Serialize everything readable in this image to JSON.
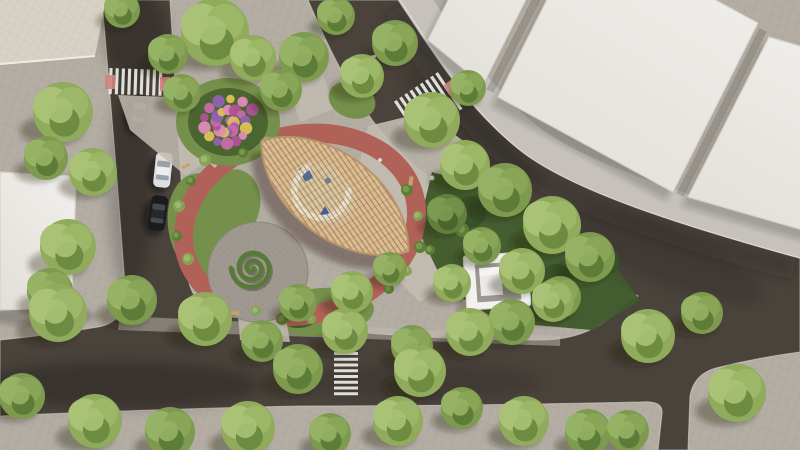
{
  "scene": {
    "view": {
      "width": 800,
      "height": 450
    }
  },
  "colors": {
    "sidewalk": "#b3ada4",
    "sidewalk_band": "#c6c2bb",
    "road": "#4a433c",
    "road_edge": "#cfc9c0",
    "building_white": "#e9e7e2",
    "building_edge": "#d3d0ca",
    "building_beige": "#d8d1c5",
    "lawn_mid": "#75904a",
    "lawn_dark": "#4a6530",
    "lawn_deep": "#3f5a2b",
    "path_light": "#c2bbb0",
    "ring_path": "#b06158",
    "cobble": "#9e978e",
    "hedge": "#577a36",
    "pergola_wood": "#dcbd92",
    "pergola_edge": "#b6956c",
    "pergola_floor": "#d9c6a2",
    "pergola_arc": "#ece2cf",
    "kiosk_white": "#f2f1ef",
    "kiosk_inner": "#999791",
    "crosswalk_stripe": "#edebe7",
    "ramp_pink": "#d4827c",
    "shadow": "rgba(25,22,16,0.32)"
  },
  "tree_palettes": [
    [
      "#8fab5b",
      "#a9c276",
      "#6d8c41",
      "#9cb768"
    ],
    [
      "#7d9a4e",
      "#96b264",
      "#5d7c38",
      "#88a558"
    ],
    [
      "#637f3d",
      "#7d9a52",
      "#4c652f",
      "#719048"
    ]
  ],
  "trees": [
    [
      122,
      10,
      18,
      1
    ],
    [
      215,
      32,
      34,
      0
    ],
    [
      168,
      54,
      20,
      1
    ],
    [
      253,
      58,
      23,
      0
    ],
    [
      304,
      57,
      25,
      1
    ],
    [
      336,
      16,
      19,
      1
    ],
    [
      362,
      76,
      22,
      0
    ],
    [
      395,
      43,
      23,
      1
    ],
    [
      63,
      112,
      30,
      0
    ],
    [
      46,
      158,
      22,
      1
    ],
    [
      93,
      172,
      24,
      0
    ],
    [
      68,
      247,
      28,
      0
    ],
    [
      50,
      291,
      23,
      1
    ],
    [
      182,
      93,
      19,
      1
    ],
    [
      281,
      90,
      21,
      1
    ],
    [
      432,
      120,
      28,
      0
    ],
    [
      468,
      88,
      18,
      1
    ],
    [
      465,
      165,
      25,
      0
    ],
    [
      505,
      190,
      27,
      1
    ],
    [
      552,
      225,
      29,
      0
    ],
    [
      590,
      257,
      25,
      1
    ],
    [
      447,
      214,
      20,
      2
    ],
    [
      482,
      246,
      19,
      1
    ],
    [
      522,
      271,
      23,
      0
    ],
    [
      560,
      297,
      21,
      1
    ],
    [
      452,
      283,
      19,
      0
    ],
    [
      512,
      322,
      23,
      1
    ],
    [
      553,
      301,
      21,
      0
    ],
    [
      298,
      303,
      19,
      1
    ],
    [
      352,
      292,
      21,
      0
    ],
    [
      390,
      269,
      17,
      1
    ],
    [
      58,
      313,
      29,
      0
    ],
    [
      132,
      300,
      25,
      1
    ],
    [
      205,
      319,
      27,
      0
    ],
    [
      262,
      341,
      21,
      1
    ],
    [
      345,
      331,
      23,
      0
    ],
    [
      412,
      346,
      21,
      1
    ],
    [
      470,
      332,
      24,
      0
    ],
    [
      298,
      369,
      25,
      1
    ],
    [
      420,
      371,
      26,
      0
    ],
    [
      22,
      396,
      23,
      1
    ],
    [
      95,
      421,
      27,
      0
    ],
    [
      170,
      432,
      25,
      1
    ],
    [
      248,
      428,
      27,
      0
    ],
    [
      330,
      434,
      21,
      1
    ],
    [
      398,
      421,
      25,
      0
    ],
    [
      462,
      408,
      21,
      1
    ],
    [
      524,
      421,
      25,
      0
    ],
    [
      588,
      432,
      23,
      1
    ],
    [
      648,
      336,
      27,
      0
    ],
    [
      702,
      313,
      21,
      1
    ],
    [
      737,
      393,
      29,
      0
    ],
    [
      628,
      431,
      21,
      1
    ]
  ],
  "shrubs": [
    [
      205,
      160,
      6
    ],
    [
      191,
      181,
      5
    ],
    [
      179,
      206,
      6
    ],
    [
      177,
      236,
      5
    ],
    [
      188,
      259,
      6
    ],
    [
      243,
      153,
      5
    ],
    [
      267,
      141,
      5
    ],
    [
      407,
      190,
      6
    ],
    [
      418,
      216,
      5
    ],
    [
      420,
      247,
      6
    ],
    [
      407,
      271,
      5
    ],
    [
      389,
      289,
      5
    ],
    [
      311,
      319,
      5
    ],
    [
      282,
      319,
      6
    ],
    [
      256,
      311,
      5
    ],
    [
      462,
      230,
      7
    ],
    [
      478,
      262,
      6
    ],
    [
      430,
      250,
      5
    ]
  ],
  "stones": [
    [
      352,
      291,
      2.5
    ],
    [
      359,
      296,
      2.2
    ],
    [
      346,
      297,
      2.0
    ],
    [
      432,
      178,
      2.5
    ],
    [
      380,
      160,
      2.0
    ]
  ],
  "benches": [
    {
      "x": 213,
      "y": 302,
      "w": 10,
      "h": 3.5,
      "a": 18,
      "c": "#c7a06b"
    },
    {
      "x": 234,
      "y": 313,
      "w": 10,
      "h": 3.5,
      "a": 2,
      "c": "#c7a06b"
    },
    {
      "x": 186,
      "y": 166,
      "w": 9,
      "h": 3,
      "a": -28,
      "c": "#c7a06b"
    },
    {
      "x": 193,
      "y": 81,
      "w": 7,
      "h": 3,
      "a": 38,
      "c": "#e8e6e2"
    },
    {
      "x": 411,
      "y": 181,
      "w": 4,
      "h": 9,
      "a": 8,
      "c": "#c7a06b"
    },
    {
      "x": 372,
      "y": 57,
      "w": 8,
      "h": 3,
      "a": -15,
      "c": "#ddd9d2"
    }
  ],
  "cars": [
    {
      "x": 139,
      "y": 112,
      "a": 10,
      "body": "#26272a",
      "glass": "#4e545b",
      "roof": "#323539"
    },
    {
      "x": 163,
      "y": 170,
      "a": 6,
      "body": "#dcdedf",
      "glass": "#9aa2a8",
      "roof": "#eceeef"
    },
    {
      "x": 158,
      "y": 213,
      "a": 8,
      "body": "#1a1b1e",
      "glass": "#45494f",
      "roof": "#26282c"
    }
  ],
  "crosswalks": [
    {
      "x": 137,
      "y": 82,
      "a": 2,
      "axis": "x",
      "len": 56,
      "span": 26,
      "n": 9
    },
    {
      "x": 427,
      "y": 106,
      "a": 56,
      "axis": "y",
      "len": 44,
      "span": 56,
      "n": 9
    },
    {
      "x": 346,
      "y": 375,
      "a": 0,
      "axis": "y",
      "len": 24,
      "span": 46,
      "n": 8
    }
  ],
  "ramps": [
    {
      "x": 110,
      "y": 82,
      "w": 10,
      "h": 14,
      "a": 0
    },
    {
      "x": 165,
      "y": 84,
      "w": 10,
      "h": 14,
      "a": 0
    },
    {
      "x": 452,
      "y": 89,
      "w": 16,
      "h": 10,
      "a": 56
    },
    {
      "x": 404,
      "y": 126,
      "w": 12,
      "h": 8,
      "a": 56
    },
    {
      "x": 345,
      "y": 347,
      "w": 18,
      "h": 8,
      "a": 0
    }
  ],
  "flower_spiral": {
    "cx": 228,
    "cy": 124,
    "r0": 4,
    "r1": 29,
    "turns": 2.1,
    "dots": 30,
    "colors": [
      "#c66ca8",
      "#8f62b2",
      "#d9c355",
      "#e08cb8",
      "#b1529b"
    ]
  },
  "hedge_spiral": {
    "cx": 252,
    "cy": 268,
    "r0": 1.5,
    "r1": 21,
    "turns": 2.5
  }
}
